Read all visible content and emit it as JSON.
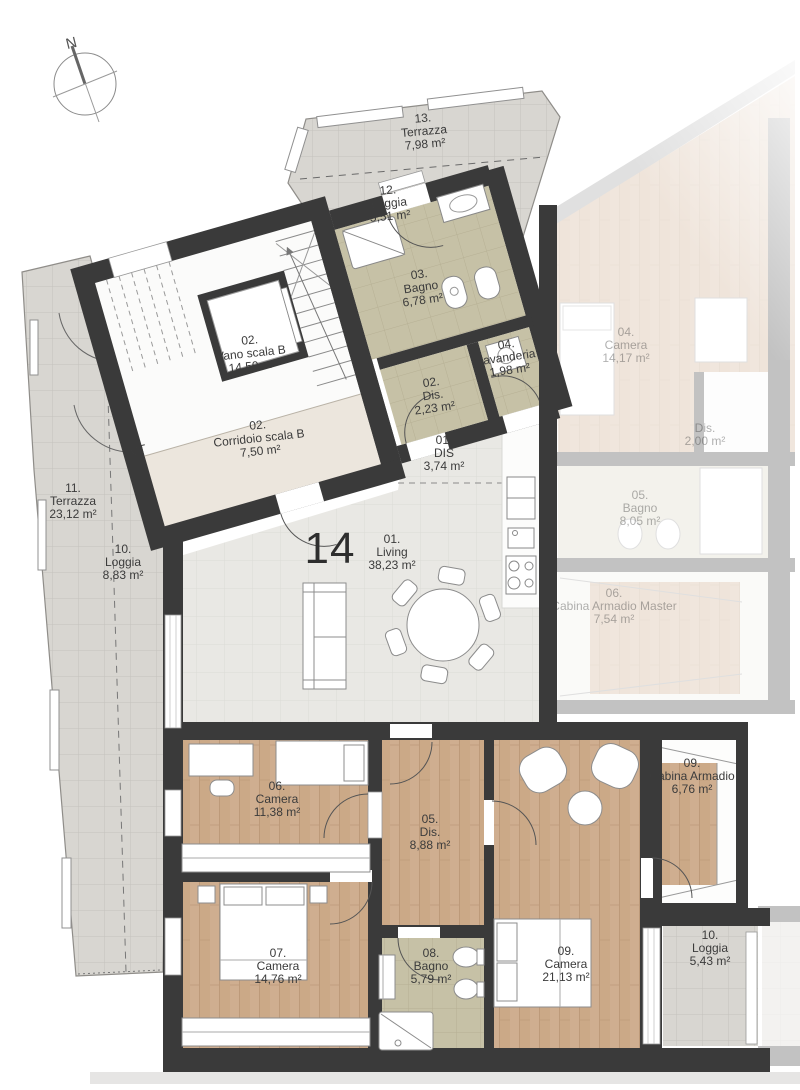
{
  "plan": {
    "apartment_number": "14",
    "compass_label": "N",
    "technical_label": "VT"
  },
  "rooms": [
    {
      "num": "13.",
      "name": "Terrazza",
      "area": "7,98 m²"
    },
    {
      "num": "12.",
      "name": "Loggia",
      "area": "5,51 m²"
    },
    {
      "num": "03.",
      "name": "Bagno",
      "area": "6,78 m²"
    },
    {
      "num": "02.",
      "name": "Vano scala B",
      "area": "14,50 m²"
    },
    {
      "num": "04.",
      "name": "lavanderia",
      "area": "1,98 m²"
    },
    {
      "num": "02.",
      "name": "Dis.",
      "area": "2,23 m²"
    },
    {
      "num": "02.",
      "name": "Corridoio scala B",
      "area": "7,50 m²"
    },
    {
      "num": "01.",
      "name": "DIS",
      "area": "3,74 m²"
    },
    {
      "num": "01.",
      "name": "Living",
      "area": "38,23 m²"
    },
    {
      "num": "11.",
      "name": "Terrazza",
      "area": "23,12 m²"
    },
    {
      "num": "10.",
      "name": "Loggia",
      "area": "8,83 m²"
    },
    {
      "num": "06.",
      "name": "Camera",
      "area": "11,38 m²"
    },
    {
      "num": "05.",
      "name": "Dis.",
      "area": "8,88 m²"
    },
    {
      "num": "09.",
      "name": "Cabina Armadio",
      "area": "6,76 m²"
    },
    {
      "num": "07.",
      "name": "Camera",
      "area": "14,76 m²"
    },
    {
      "num": "08.",
      "name": "Bagno",
      "area": "5,79 m²"
    },
    {
      "num": "09.",
      "name": "Camera",
      "area": "21,13 m²"
    },
    {
      "num": "10.",
      "name": "Loggia",
      "area": "5,43 m²"
    }
  ],
  "adjacent_rooms": [
    {
      "num": "04.",
      "name": "Camera",
      "area": "14,17 m²"
    },
    {
      "num": "",
      "name": "Dis.",
      "area": "2,00 m²"
    },
    {
      "num": "05.",
      "name": "Bagno",
      "area": "8,05 m²"
    },
    {
      "num": "06.",
      "name": "Cabina Armadio Master",
      "area": "7,54 m²"
    }
  ],
  "colors": {
    "wall": "#3a3a3a",
    "wood_floor": "#cfae90",
    "terrace_tile": "#d8d6d1",
    "bath_tile": "#c6c1a6",
    "living_tile": "#e9e8e4",
    "corridor_floor": "#ece6dd",
    "label_text": "#3b3b3b"
  }
}
